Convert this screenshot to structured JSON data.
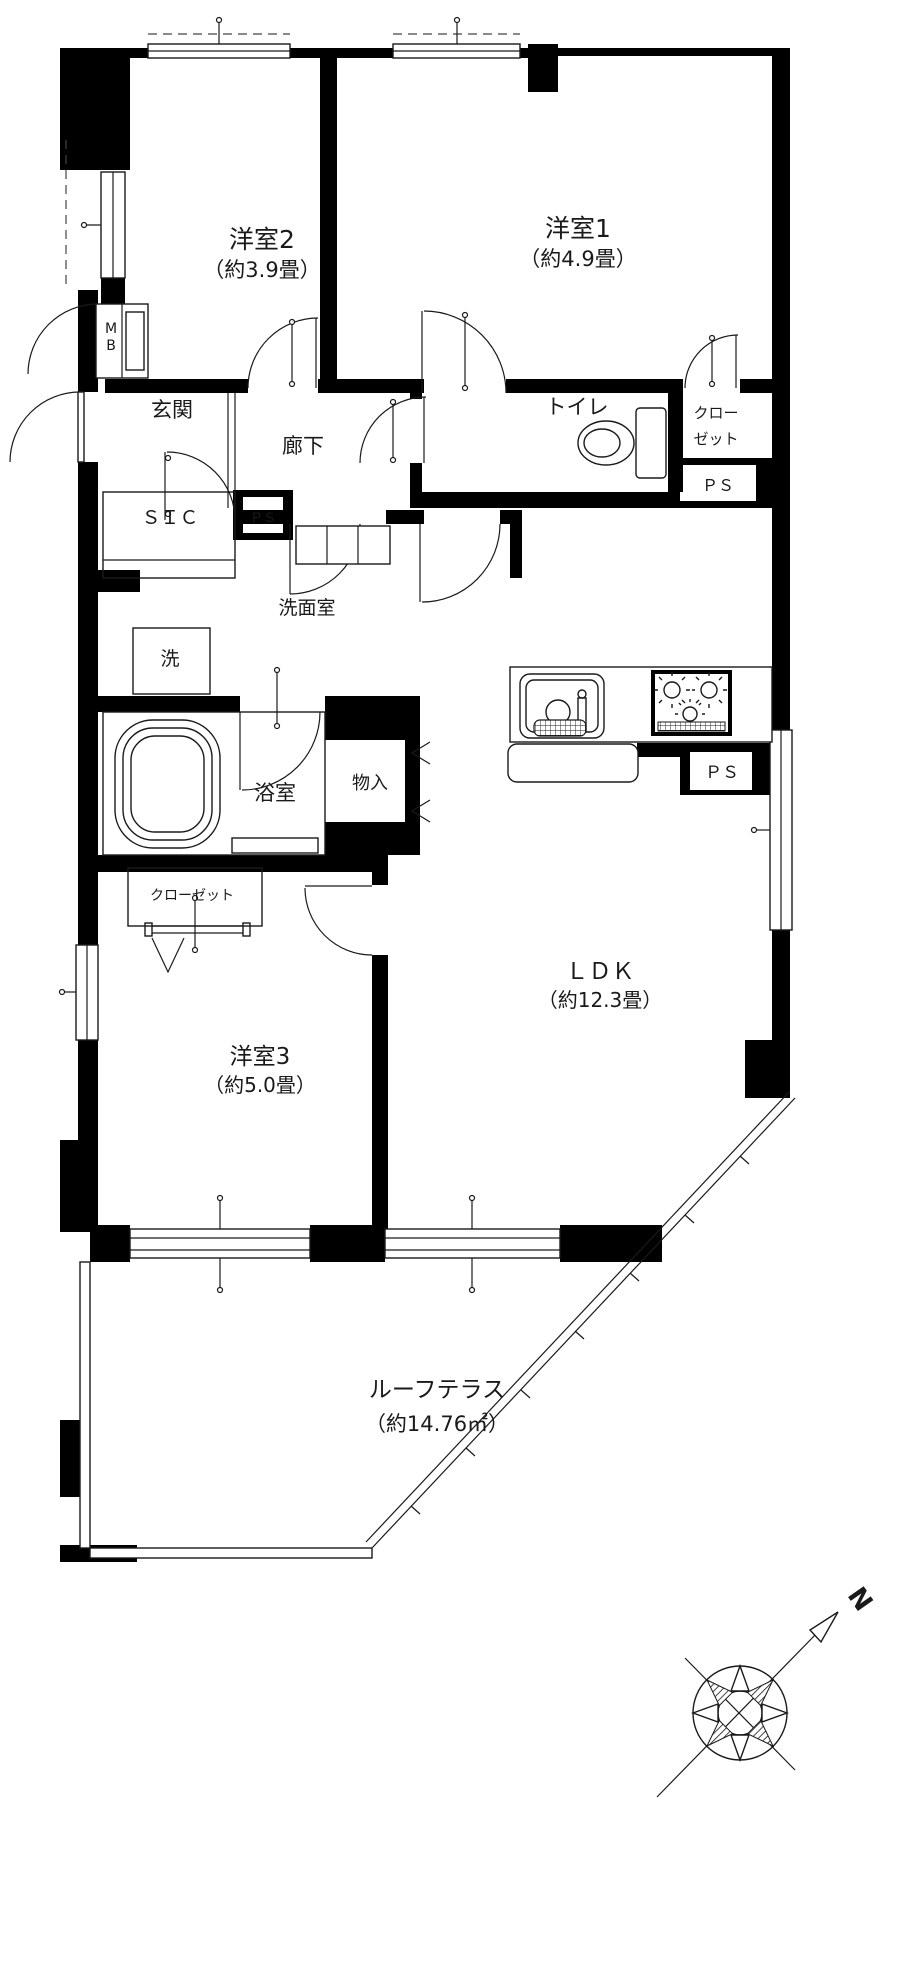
{
  "colors": {
    "wall": "#000000",
    "line": "#1a1a1a",
    "background": "#ffffff"
  },
  "rooms": {
    "yoshitsu2": {
      "name": "洋室2",
      "size": "（約3.9畳）"
    },
    "yoshitsu1": {
      "name": "洋室1",
      "size": "（約4.9畳）"
    },
    "yoshitsu3": {
      "name": "洋室3",
      "size": "（約5.0畳）"
    },
    "ldk": {
      "name": "ＬＤＫ",
      "size": "（約12.3畳）"
    },
    "roof_terrace": {
      "name": "ルーフテラス",
      "size": "（約14.76㎡）"
    },
    "genkan": {
      "name": "玄関"
    },
    "rouka": {
      "name": "廊下"
    },
    "toilet": {
      "name": "トイレ"
    },
    "senmenshitsu": {
      "name": "洗面室"
    },
    "yokushitsu": {
      "name": "浴室"
    },
    "laundry": {
      "name": "洗"
    },
    "sic": {
      "name": "ＳＩＣ"
    },
    "monoire": {
      "name": "物入"
    },
    "closet_right": {
      "line1": "クロー",
      "line2": "ゼット"
    },
    "closet_left": {
      "name": "クローゼット"
    }
  },
  "utilities": {
    "meter_box": {
      "line1": "M",
      "line2": "B"
    },
    "ps_entrance": "ＰＳ",
    "ps_closet": "ＰＳ",
    "ps_kitchen": "ＰＳ"
  },
  "compass": {
    "north_label": "N"
  },
  "icons": {
    "compass_rose": "8-point star in circle with NE needle arrow",
    "toilet_fixture": "tank and bowl",
    "bathtub": "rounded tub",
    "kitchen_sink": "sink with faucet and drain",
    "gas_stove": "3-burner stove with grill",
    "door_swing": "quarter-circle arcs",
    "window": "double-line sash"
  }
}
